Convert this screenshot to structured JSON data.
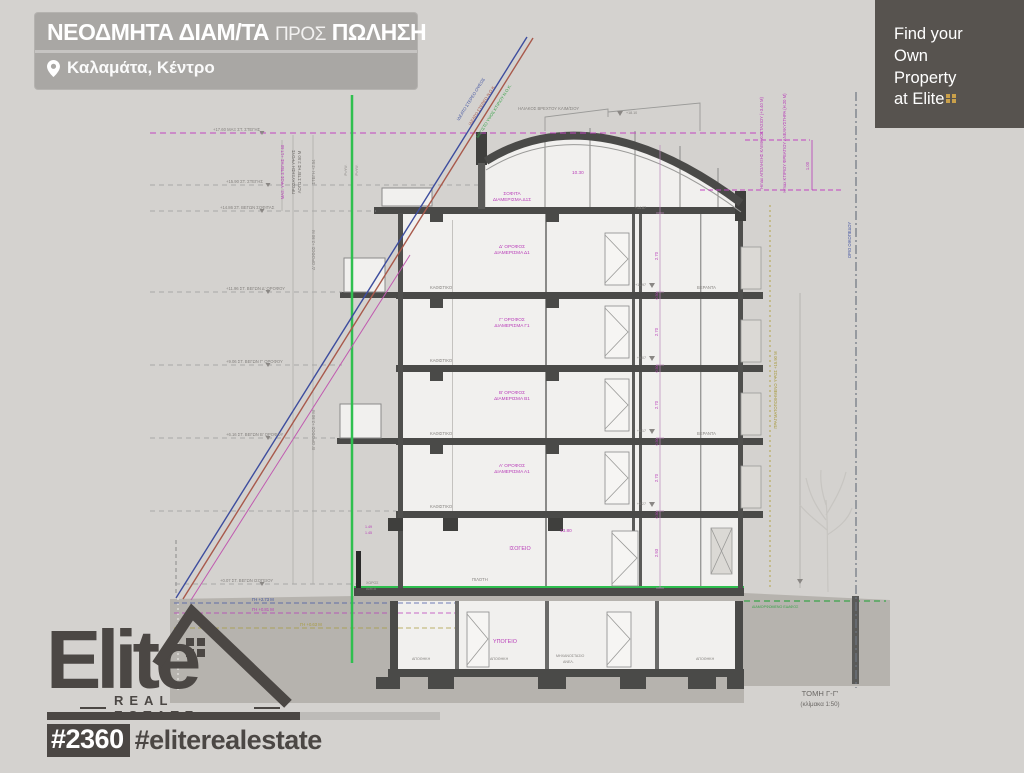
{
  "header": {
    "title_bold1": "ΝΕΟΔΜΗΤΑ ΔΙΑΜ/ΤΑ",
    "title_light": "ΠΡΟΣ",
    "title_bold2": "ΠΩΛΗΣΗ",
    "location": "Καλαμάτα, Κέντρο"
  },
  "promo": {
    "l1": "Find your",
    "l2": "Own",
    "l3": "Property",
    "l4": "at Elite"
  },
  "brand": {
    "logo_text": "Elite",
    "logo_sub": "REAL ESTATE",
    "hashtag_id": "#2360",
    "hashtag_name": "#eliterealestate"
  },
  "colors": {
    "accent_green": "#2fbf4f",
    "magenta": "#c244c2",
    "blue": "#3d4d9e",
    "red": "#a8594b",
    "olive": "#b5a44a",
    "dark": "#4b4744",
    "promo_bg": "#57534f",
    "header_bg": "#a9a7a4",
    "gold": "#c9a04a"
  },
  "drawing": {
    "title": "ΤΟΜΗ Γ-Γ'",
    "scale": "(κλίμακα 1:50)",
    "top_note": "ΗΛΙΑΚΟΣ ΒΡΕΧΤΟΥ ΚΛΙΜ/ΣΙΟΥ",
    "top_level": "+18.10",
    "levels": [
      "+17.60 ΜΑΞ ΣΤ. ΣΤΕΓΗΣ",
      "+15.90 ΣΤ. ΣΤΕΓΗΣ",
      "+14.86 ΣΤ. ΒΕΓΩΝ ΣΟΦΙΤΑΣ",
      "+11.96 ΣΤ. ΒΕΓΩΝ Δ' ΟΡΟΦΟΥ",
      "+9.06 ΣΤ. ΒΕΓΩΝ Γ' ΟΡΟΦΟΥ",
      "+6.16 ΣΤ. ΒΕΓΩΝ Β' ΟΡΟΦΟΥ",
      "+0.07 ΣΤ. ΒΕΓΩΝ ΙΣΟΓΕΙΟΥ"
    ],
    "rot_left": [
      "ΜΑΞ. ΥΨΟΣ ΣΤΕΓΗΣ +17.60",
      "ΠΡΟΣΑΥΞΗΣΗ ΥΨΟΥΣ",
      "ΛΟΓΩ ΣΤΕΓΗΣ 2.50 Μ",
      "ΣΤΕΓΗ +2.54",
      "Δ' ΟΡΟΦΟΣ +2.90 Μ",
      "Β' ΟΡΟΦΟΣ +2.90 Μ",
      "Ρ=ΥΨ."
    ],
    "diag": [
      "ΙΔΕΑΤΟ ΣΤΕΡΕΟ ΟΨΕΩΣ",
      "ΙΔΕΑΤΟ ΣΤΕΡΕΟ Ν.Ο.Κ.",
      "ΜΕΓΙΣΤΟ ΥΨΟΣ ΚΤΙΡΙΟΥ Ν.Ο.Κ."
    ],
    "floors": [
      {
        "l1": "ΣΟΦΙΤΑ",
        "l2": "ΔΙΑΜΕΡΙΣΜΑ Δ1Σ"
      },
      {
        "l1": "Δ' ΟΡΟΦΟΣ",
        "l2": "ΔΙΑΜΕΡΙΣΜΑ Δ1"
      },
      {
        "l1": "Γ' ΟΡΟΦΟΣ",
        "l2": "ΔΙΑΜΕΡΙΣΜΑ Γ1"
      },
      {
        "l1": "Β' ΟΡΟΦΟΣ",
        "l2": "ΔΙΑΜΕΡΙΣΜΑ Β1"
      },
      {
        "l1": "Α' ΟΡΟΦΟΣ",
        "l2": "ΔΙΑΜΕΡΙΣΜΑ Α1"
      },
      {
        "l1": "ΙΣΟΓΕΙΟ"
      },
      {
        "l1": "ΥΠΟΓΕΙΟ"
      }
    ],
    "rooms": {
      "living": "ΚΑΘΙΣΤΙΚΟ",
      "veranda": "ΒΕΡΑΝΤΑ",
      "pilotis": "ΠΙΛΟΤΗ",
      "amea1": "ΧΩΡΟΣ",
      "amea2": "ΑΜΕΑ",
      "storage": "ΑΠΟΘΗΚΗ",
      "machine1": "ΜΗΧΑΝΟΣΤΑΣΙΟ",
      "machine2": "ΑΝΕΛ."
    },
    "dims": {
      "floor": "2.70",
      "ground_floor": "2.93",
      "slab": "0.30",
      "total": "13.80",
      "sofita": "10.30",
      "head": "1.00",
      "d1": "1.49",
      "d2": "1.45"
    },
    "marks": {
      "m0": "+14.87",
      "m1": "+11.97",
      "m2": "+9.07",
      "m3": "+6.17",
      "m4": "+3.27"
    },
    "right": {
      "hmax1": "Ηmax ΑΠΟΛΗΞΗΣ ΚΛΙΜΑΚΟΣΤΑΣΙΟΥ (+3.40 Μ)",
      "hmax2": "Ηmax ΚΤΙΡΙΟΥ ΦΡΕΑΤΙΟΥ ΑΝΕΛΚΥΣΤΗΡΑ (Η.20 Μ)",
      "realized": "ΠΡΑΓΜΑΤΟΠΟΙΗΜΕΝΟ ΥΨΟΣ +15.90 Μ",
      "boundary": "ΟΡΙΟ ΟΙΚΟΠΕΔΟΥ",
      "ground": "ΔΙΑΜΟΡΦΩΜΕΝΟ ΕΔΑΦΟΣ"
    },
    "gh": [
      "ΓΗ +2.73 Μ",
      "ΓΗ +0.81 Μ",
      "ΓΗ +0.63 Μ"
    ]
  }
}
